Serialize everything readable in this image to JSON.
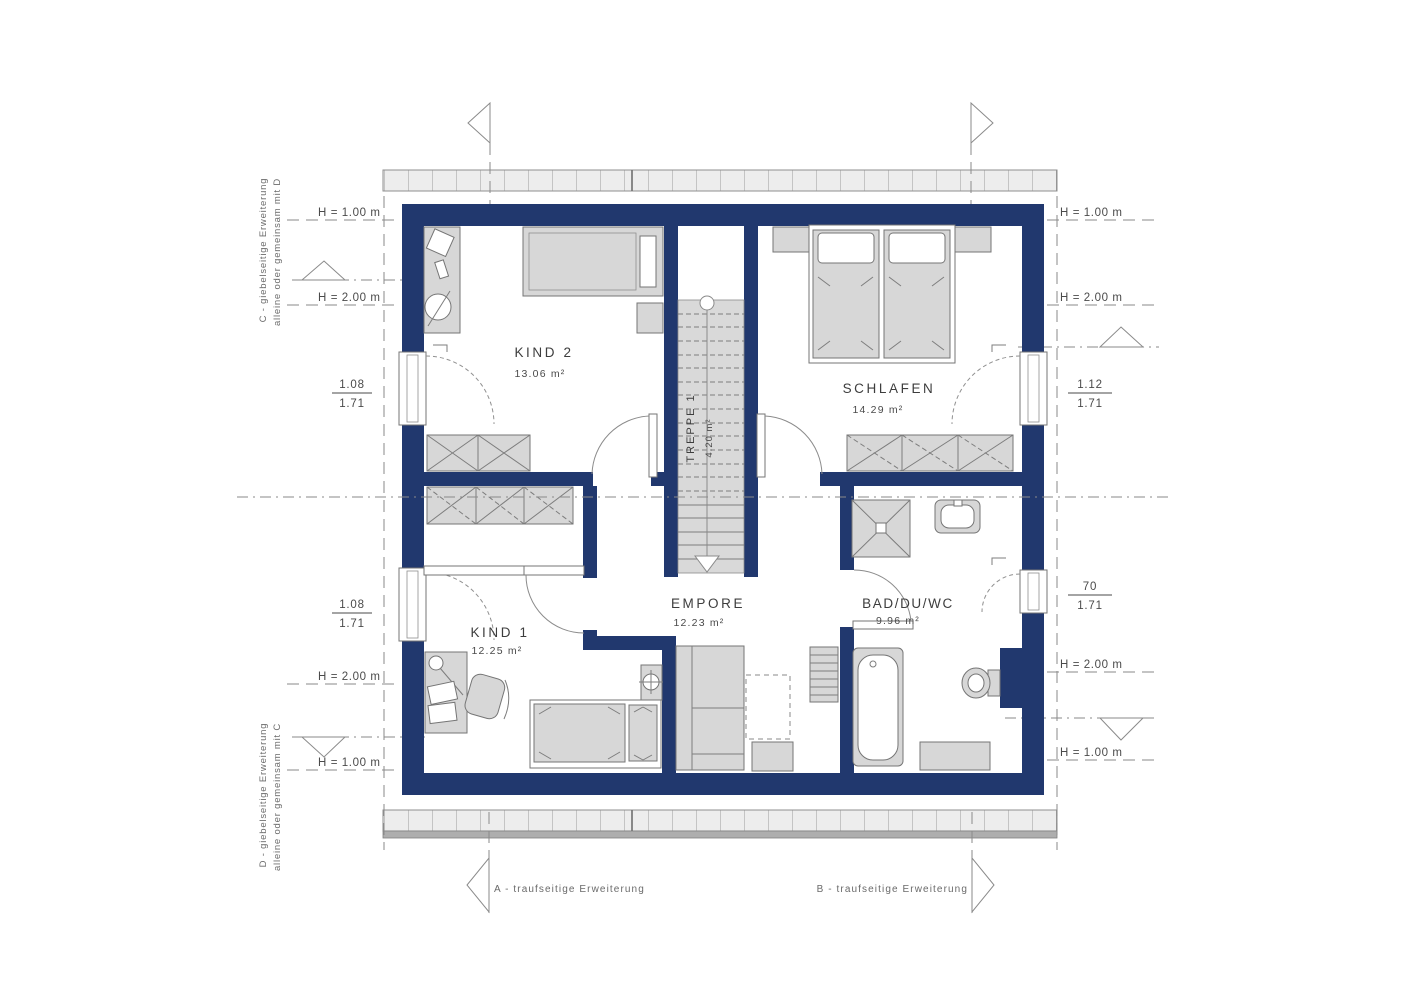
{
  "plan": {
    "rooms": [
      {
        "name": "KIND 2",
        "area": "13.06 m²"
      },
      {
        "name": "SCHLAFEN",
        "area": "14.29 m²"
      },
      {
        "name": "KIND 1",
        "area": "12.25 m²"
      },
      {
        "name": "EMPORE",
        "area": "12.23 m²"
      },
      {
        "name": "BAD/DU/WC",
        "area": "9.96 m²"
      },
      {
        "name": "TREPPE 1",
        "area": "4.20 m²"
      }
    ]
  },
  "annotations": {
    "left": {
      "h1_top": "H = 1.00 m",
      "h2_top": "H = 2.00 m",
      "win1_num": "1.08",
      "win1_den": "1.71",
      "win2_num": "1.08",
      "win2_den": "1.71",
      "h2_bottom": "H = 2.00 m",
      "h1_bottom": "H = 1.00 m"
    },
    "right": {
      "h1_top": "H = 1.00 m",
      "h2_top": "H = 2.00 m",
      "win1_num": "1.12",
      "win1_den": "1.71",
      "win2_num": "70",
      "win2_den": "1.71",
      "h2_bottom": "H = 2.00 m",
      "h1_bottom": "H = 1.00 m"
    },
    "side_texts": {
      "top_line1": "C - giebelseitige Erweiterung",
      "top_line2": "alleine oder gemeinsam mit D",
      "bottom_line1": "D - giebelseitige Erweiterung",
      "bottom_line2": "alleine oder gemeinsam mit C"
    },
    "bottom": {
      "a": "A - traufseitige Erweiterung",
      "b": "B - traufseitige Erweiterung"
    }
  },
  "colors": {
    "wall": "#21386e",
    "furniture_fill": "#d7d7d7",
    "furniture_stroke": "#757575",
    "hatch_fill": "#ededed",
    "annotation_text": "#4a4a4a"
  }
}
